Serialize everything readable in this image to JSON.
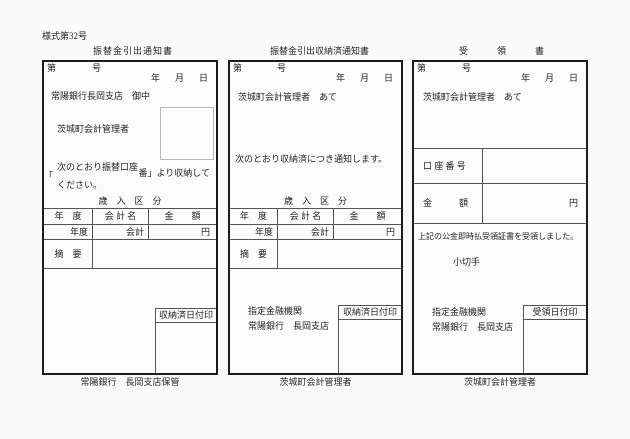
{
  "page": {
    "form_code": "様式第32号"
  },
  "shared": {
    "doc_no_prefix": "第",
    "doc_no_suffix": "号",
    "date_year": "年",
    "date_month": "月",
    "date_day": "日"
  },
  "table": {
    "section_title": "歳　入　区　分",
    "col_year": "年　度",
    "col_account": "会 計 名",
    "col_amount": "金　　額",
    "cell_year": "年度",
    "cell_account": "会計",
    "cell_unit": "円",
    "note_label": "摘　要"
  },
  "panel1": {
    "title": "振替金引出通知書",
    "addressee": "常陽銀行長岡支店　御中",
    "manager": "茨城町会計管理者",
    "body_line1": "次のとおり振替口座",
    "bracket": "「",
    "body_line2": "番」より収納して",
    "body_line3": "ください。",
    "stamp_label": "収納済日付印",
    "footer": "常陽銀行　長岡支店保管"
  },
  "panel2": {
    "title": "振替金引出収納済通知書",
    "addressee": "茨城町会計管理者　あて",
    "body": "次のとおり収納済につき通知します。",
    "bank_label": "指定金融機関",
    "bank_name": "常陽銀行　長岡支店",
    "stamp_label": "収納済日付印",
    "footer": "茨城町会計管理者"
  },
  "panel3": {
    "title": "受領書",
    "addressee": "茨城町会計管理者　あて",
    "account_label": "口 座 番 号",
    "amount_label": "金　　　額",
    "amount_unit": "円",
    "receipt_text": "上記の公金即時払受領証書を受領しました。",
    "cheque_label": "小切手",
    "bank_label": "指定金融機関",
    "bank_name": "常陽銀行　長岡支店",
    "stamp_label": "受領日付印",
    "footer": "茨城町会計管理者"
  }
}
